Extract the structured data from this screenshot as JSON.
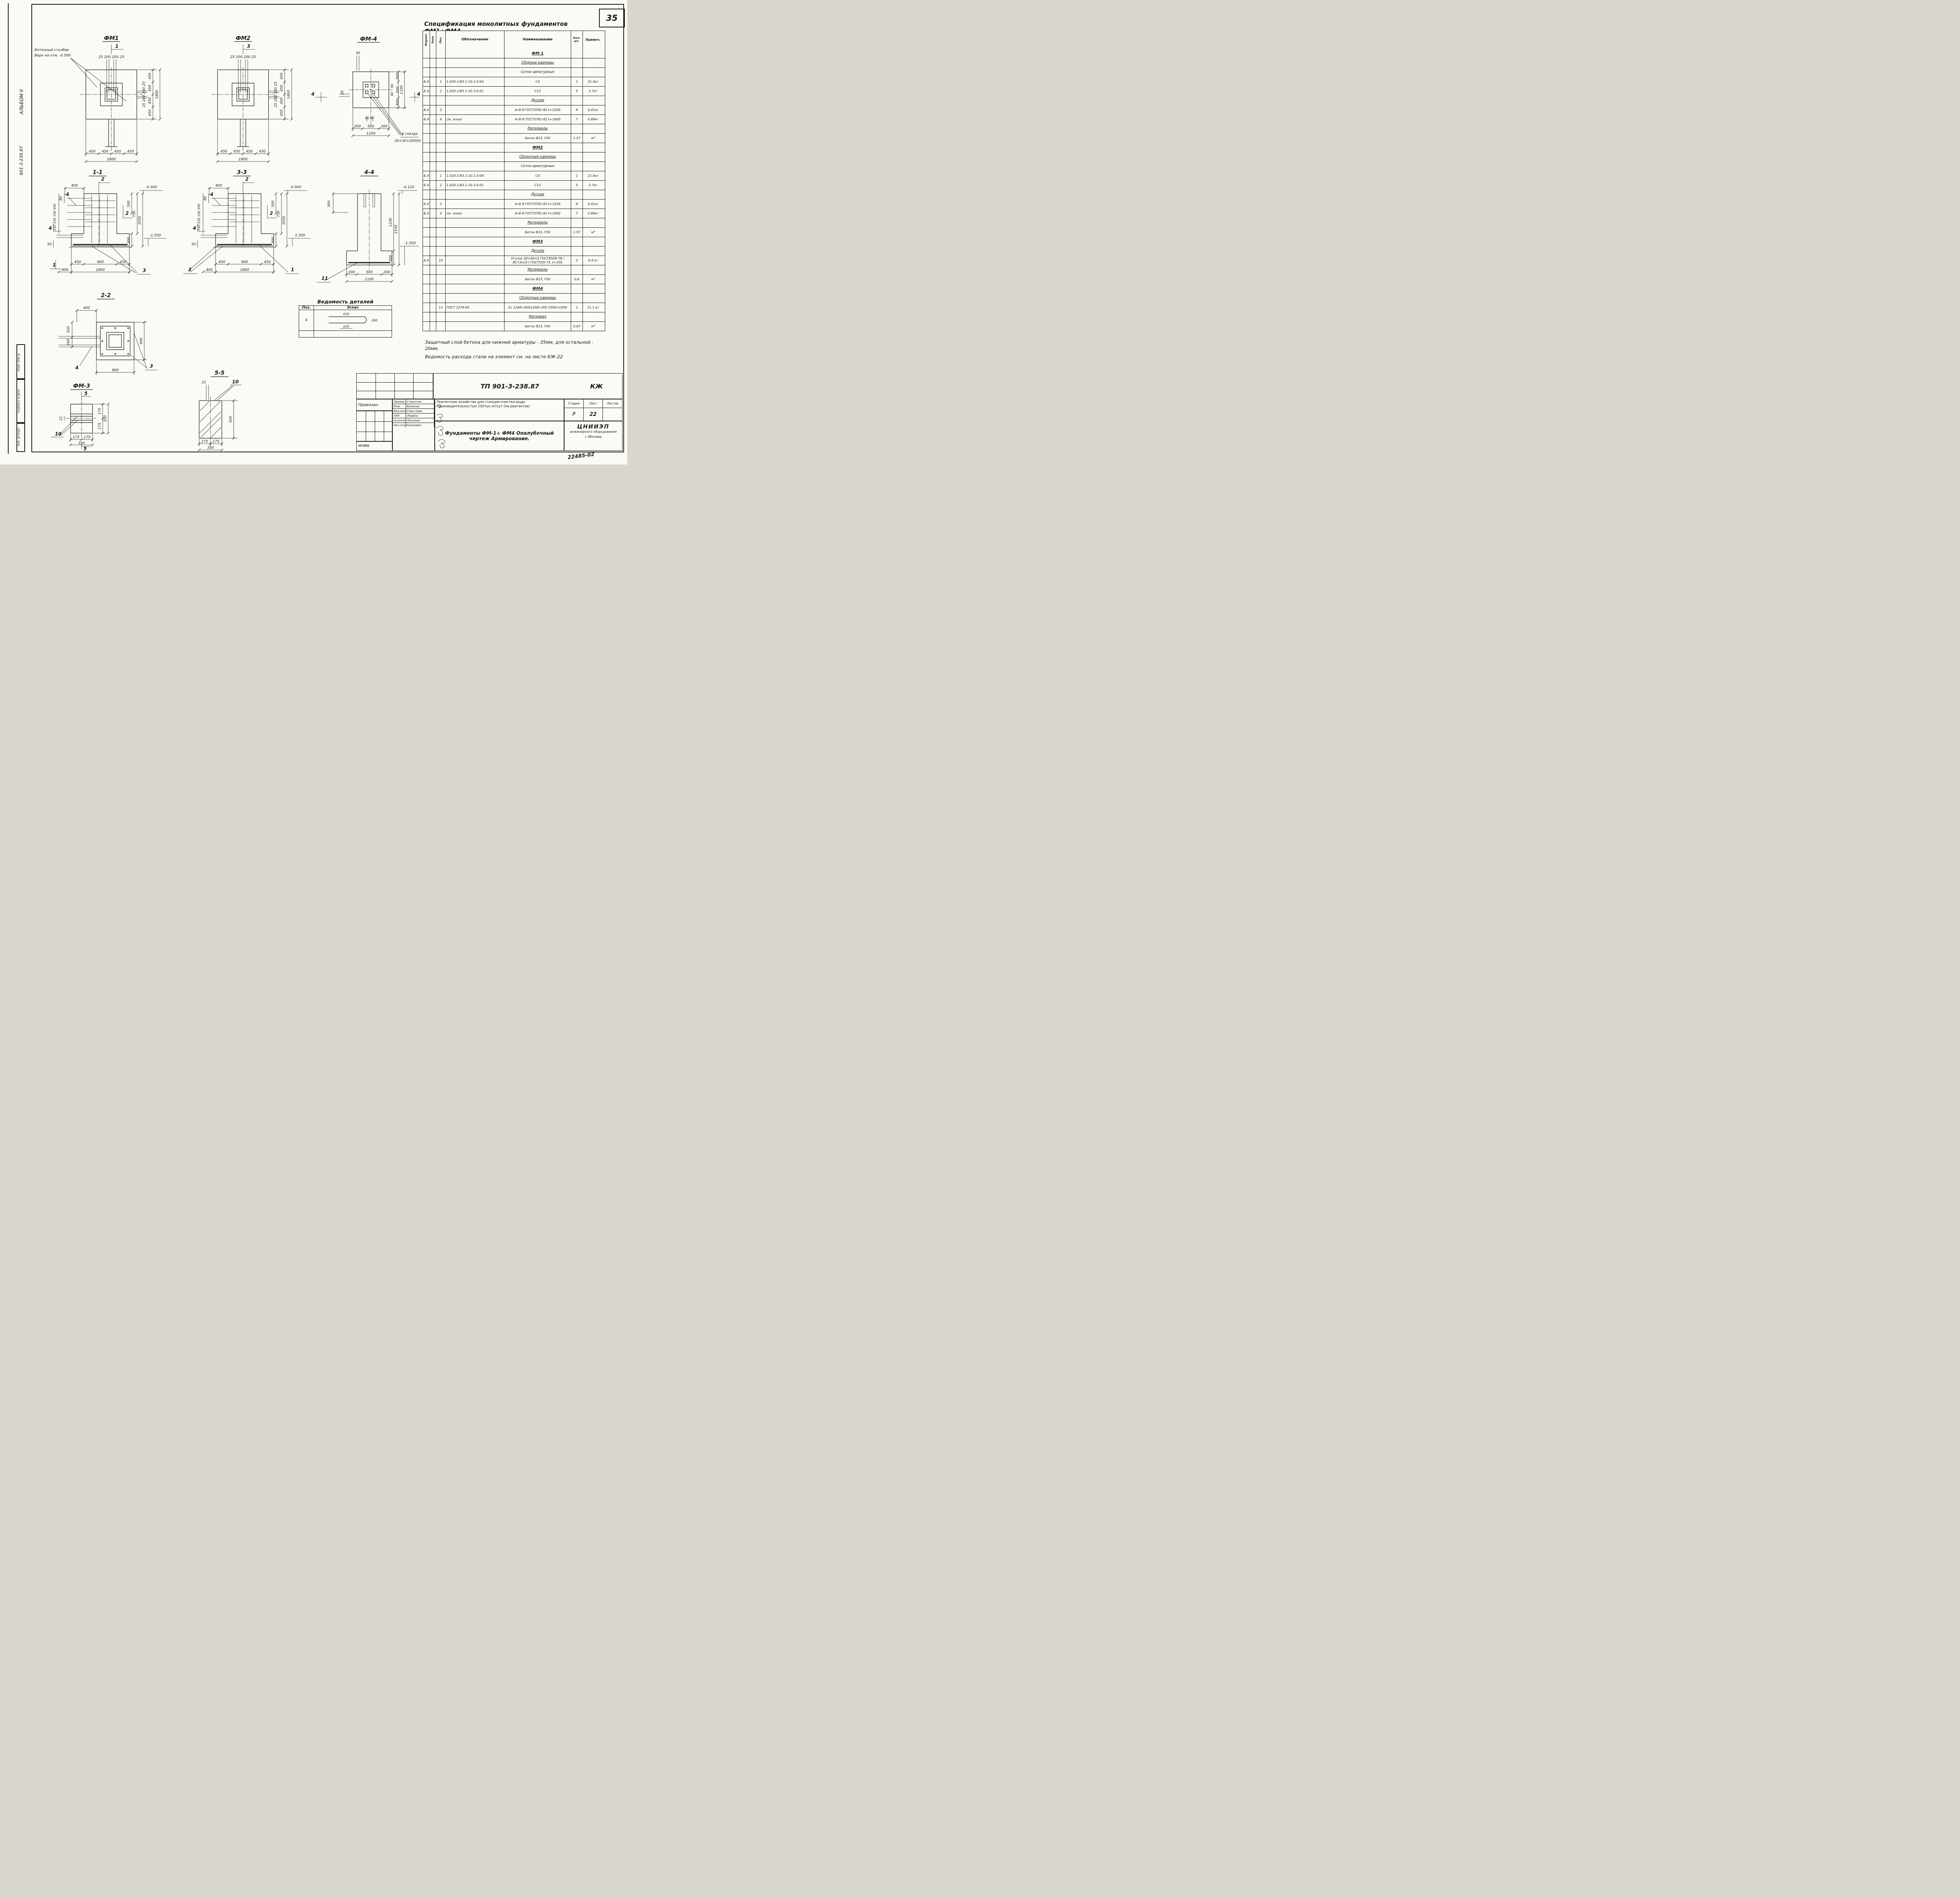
{
  "page": {
    "number": "35",
    "doc_no": "22485-02"
  },
  "sidebar": {
    "album": "АЛЬБОМ II",
    "code": "901-3-238.87",
    "stamps": [
      "ВЗАМ. ИНВ №",
      "ПОДПИСЬ И ДАТА",
      "ИНВ. №ПОДЛ"
    ]
  },
  "notes": [
    "Защитный слой бетона для нижней арматуры - 35мм, для остальной - 20мм.",
    "Ведомость расхода стали на элемент см. на листе КЖ-22"
  ],
  "spec_table": {
    "title": "Спецификация монолитных фундаментов ФМ1÷ФМ4",
    "columns": [
      "Формат",
      "Зона",
      "Поз.",
      "Обозначение",
      "Наименование",
      "Кол. шт.",
      "Примеч."
    ],
    "rows": [
      {
        "type": "group",
        "name": "ФМ 1"
      },
      {
        "type": "sub",
        "name": "Сборные единицы"
      },
      {
        "type": "plain",
        "name": "Сетки арматурные"
      },
      {
        "type": "item",
        "format": "Б.4",
        "pos": "1",
        "designation": "1.020-1/83.1-10.1.0-04",
        "name": "С4",
        "qty": "1",
        "note": "21.6кг"
      },
      {
        "type": "item",
        "format": "Б.4",
        "pos": "2",
        "designation": "1.020-1/83.1-10.3.0-01",
        "name": "С13",
        "qty": "5",
        "note": "2.7кг"
      },
      {
        "type": "sub",
        "name": "Детали"
      },
      {
        "type": "item",
        "format": "Б.4",
        "pos": "3",
        "designation": "",
        "name": "А-III-8 ГОСТ5781-82 ℓ=1030",
        "qty": "8",
        "note": "0.41кг"
      },
      {
        "type": "item",
        "format": "Б.4",
        "pos": "4",
        "designation": "см. эскиз",
        "name": "А-III-8 ГОСТ5781-82 ℓ=1600",
        "qty": "7",
        "note": "0.99кг"
      },
      {
        "type": "sub",
        "name": "Материалы"
      },
      {
        "type": "item",
        "format": "",
        "pos": "",
        "designation": "",
        "name": "Бетон В15, F50",
        "qty": "1.57",
        "note": "м³"
      },
      {
        "type": "group",
        "name": "ФМ2"
      },
      {
        "type": "sub",
        "name": "Сборочные единицы"
      },
      {
        "type": "plain",
        "name": "Сетки арматурные"
      },
      {
        "type": "item",
        "format": "Б.4",
        "pos": "1",
        "designation": "1.020-1/83.1-10.1.0-04",
        "name": "С4",
        "qty": "1",
        "note": "21.6кг"
      },
      {
        "type": "item",
        "format": "Б.4",
        "pos": "2",
        "designation": "1.020-1/83.1-10.3.0-01",
        "name": "С13",
        "qty": "5",
        "note": "2.7кг"
      },
      {
        "type": "sub",
        "name": "Детали"
      },
      {
        "type": "item",
        "format": "Б.4",
        "pos": "3",
        "designation": "",
        "name": "А-III-8 ГОСТ5781-82 ℓ=1030",
        "qty": "8",
        "note": "0.41кг"
      },
      {
        "type": "item",
        "format": "Б.4",
        "pos": "4",
        "designation": "см. эскиз",
        "name": "А-III-8 ГОСТ5781-82 ℓ=1600",
        "qty": "7",
        "note": "0.99кг"
      },
      {
        "type": "sub",
        "name": "Материалы"
      },
      {
        "type": "item",
        "format": "",
        "pos": "",
        "designation": "",
        "name": "Бетон В15, F50",
        "qty": "1.57",
        "note": "м³"
      },
      {
        "type": "group",
        "name": "ФМ3"
      },
      {
        "type": "sub",
        "name": "Детали"
      },
      {
        "type": "item",
        "format": "Б.4",
        "pos": "10",
        "designation": "",
        "name": "Уголок 50×50×5 ГОСТ8509-78 / ВСт3кп2-I ГОСТ535-75, ℓ=350",
        "qty": "2",
        "note": "0.4 кг"
      },
      {
        "type": "sub",
        "name": "Материалы"
      },
      {
        "type": "item",
        "format": "",
        "pos": "",
        "designation": "",
        "name": "Бетон В15, F50",
        "qty": "0.6",
        "note": "м³"
      },
      {
        "type": "group",
        "name": "ФМ4"
      },
      {
        "type": "sub",
        "name": "Сборочные единицы"
      },
      {
        "type": "item",
        "format": "",
        "pos": "11",
        "designation": "ГОСТ 2379-85",
        "name": "2с 12АIII-200/12АIII-200 1050×1050",
        "qty": "1",
        "note": "11.1 кг"
      },
      {
        "type": "sub",
        "name": "Материал"
      },
      {
        "type": "item",
        "format": "",
        "pos": "",
        "designation": "",
        "name": "Бетон В15, F50",
        "qty": "0.67",
        "note": "м³"
      }
    ]
  },
  "fm1": {
    "title": "ФМ1",
    "cut": "1",
    "callout1": "Бетонный столбик",
    "callout2": "Верх на отм. -0.500",
    "top_dims": "25 200 200 25",
    "side_dims": "25 200 200 25",
    "right_chain": [
      "450",
      "450",
      "450",
      "450"
    ],
    "right_total": "1800",
    "bottom_chain": [
      "450",
      "450",
      "450",
      "450"
    ],
    "bottom_total": "1800"
  },
  "fm2": {
    "title": "ФМ2",
    "cut": "3",
    "top_dims": "25 200 200 25",
    "side_dims": "25 200 200 25",
    "right_chain": [
      "450",
      "450",
      "450",
      "450"
    ],
    "right_total": "1800",
    "bottom_chain": [
      "450",
      "450",
      "450",
      "450"
    ],
    "bottom_total": "1800"
  },
  "fm4": {
    "title": "ФМ-4",
    "cut_left": "4",
    "cut_right": "4",
    "top_dim": "30",
    "left_dim": "30",
    "gap1": "90",
    "gap2": "90",
    "bottom_small": "90 90",
    "right_chain": [
      "300",
      "500",
      "300"
    ],
    "right_total": "1100",
    "bottom_chain": [
      "300",
      "500",
      "300"
    ],
    "bottom_total": "1100",
    "note1": "4 гнезда",
    "note2": "30×30×300(h)"
  },
  "s11": {
    "title": "1-1",
    "cut_top": "2",
    "cut_mid": "2",
    "top_dim": "400",
    "pos4": "4",
    "pos4b": "4",
    "pos1": "1",
    "pos3": "3",
    "left_top": "80",
    "left_chain": "150 150 150 100",
    "left_bottom": "50",
    "d500": "500",
    "d750": "750",
    "d1050": "1050",
    "d300": "300",
    "elev_top": "-0.500",
    "elev_bottom": "-1.550",
    "bottom_chain": [
      "450",
      "900",
      "450"
    ],
    "bottom_offset": "400",
    "bottom_total": "1800"
  },
  "s33": {
    "title": "3-3",
    "cut_top": "2",
    "cut_mid": "2",
    "top_dim": "400",
    "pos4": "4",
    "pos4b": "4",
    "pos1": "1",
    "pos3": "3",
    "left_top": "80",
    "left_chain": "150 150 150 100",
    "left_bottom": "50",
    "d500": "500",
    "d750": "750",
    "d1050": "1050",
    "d300": "300",
    "elev_top": "-0.500",
    "elev_bottom": "-1.550",
    "bottom_chain": [
      "450",
      "900",
      "450"
    ],
    "bottom_offset": "400",
    "bottom_total": "1800"
  },
  "s44": {
    "title": "4-4",
    "left_dim": "300",
    "pos11": "11",
    "d1230": "1230",
    "d1530": "1530",
    "d300": "300",
    "elev_top": "-0.120",
    "elev_bottom": "-1.550",
    "bottom_chain": [
      "300",
      "500",
      "300"
    ],
    "bottom_total": "1100"
  },
  "s22": {
    "title": "2-2",
    "top_dim": "400",
    "left_d1": "320",
    "left_d2": "260",
    "right_dim": "900",
    "bottom_dim": "900",
    "pos4": "4",
    "pos3": "3"
  },
  "fm3": {
    "title": "ФМ-3",
    "cut_top": "5",
    "cut_bottom": "5",
    "left_dim": "21",
    "pos10": "10",
    "right_chain": [
      "175",
      "175"
    ],
    "right_total": "350",
    "bottom_chain": [
      "175",
      "175"
    ],
    "bottom_total": "350"
  },
  "s55": {
    "title": "5-5",
    "top_dim": "21",
    "pos10": "10",
    "right_dim": "500",
    "bottom_chain": [
      "175",
      "175"
    ],
    "bottom_total": "350"
  },
  "vedomost": {
    "title": "Ведомость деталей",
    "col_pos": "Поз.",
    "col_sketch": "Эскиз",
    "row_pos": "4",
    "sk_top": "670",
    "sk_bottom": "670",
    "sk_bend": "260"
  },
  "titleblock": {
    "tp": "ТП 901-3-238.87",
    "mark": "КЖ",
    "binding": "Привязан",
    "inv": "ИНВ№",
    "rows": [
      [
        "Провер.",
        "Стронгин"
      ],
      [
        "Инж.",
        "Базанов"
      ],
      [
        "Вед.инж.",
        "Смыслова"
      ],
      [
        "ГИП",
        "Левина"
      ],
      [
        "Н.контр.",
        "Письман"
      ],
      [
        "Нач.отд.",
        "Красавин"
      ]
    ],
    "project": "Реагентное хозяйство для станции очистки воды производительностью 100тыс.м³/сут (на реагентах)",
    "stage_label": "Стадия",
    "sheet_label": "Лист",
    "sheets_label": "Листов",
    "stage": "Р",
    "sheet": "22",
    "subject": "Фундаменты ФМ-1÷ ФМ4 Опалубочный чертеж Армирование.",
    "org1": "ЦНИИЭП",
    "org2": "инженерного оборудования",
    "org3": "г Москва"
  }
}
